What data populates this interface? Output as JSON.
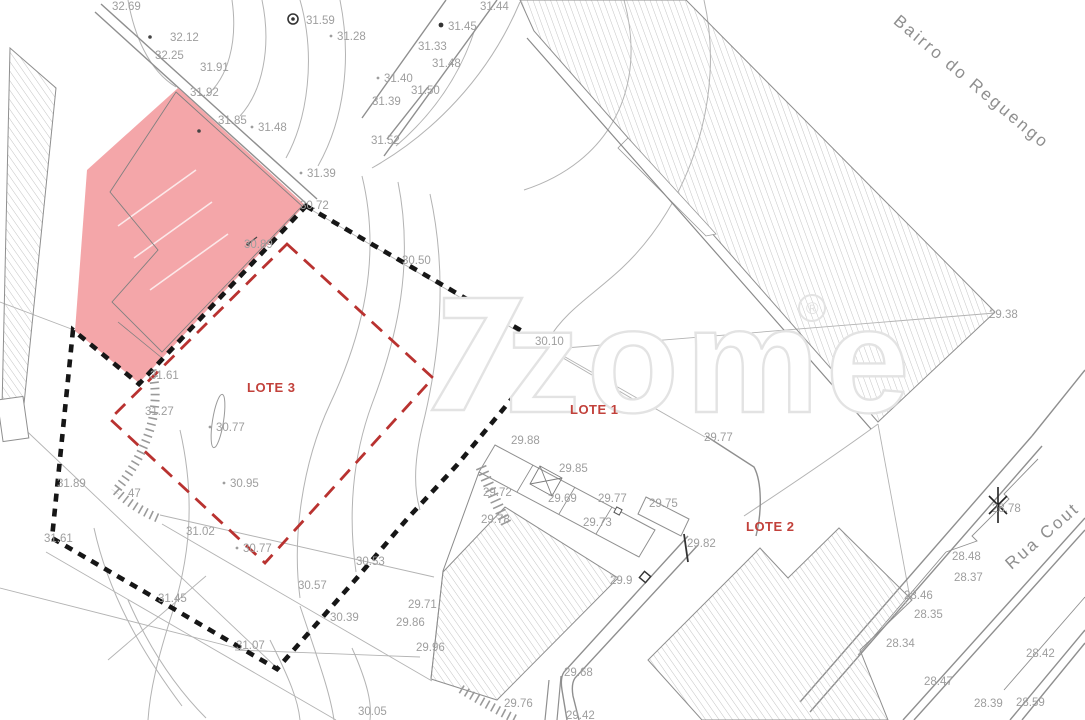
{
  "colors": {
    "pink": "#f4a6a9",
    "red_dash": "#b93230",
    "lot_red": "#c2413b",
    "elev_gray": "#9e9e9e",
    "line_gray": "#b3b3b3",
    "road_gray": "#8f8f8f",
    "hatch_gray": "#bdbdbd"
  },
  "watermark": {
    "text": "zome",
    "registered": "®"
  },
  "streets": [
    {
      "name": "Bairro do Reguengo",
      "x": 968,
      "y": 86,
      "rotate": 40
    },
    {
      "name": "Rua Cout",
      "x": 1046,
      "y": 540,
      "rotate": -41
    }
  ],
  "lots": [
    {
      "label": "LOTE 3",
      "x": 247,
      "y": 392
    },
    {
      "label": "LOTE 1",
      "x": 570,
      "y": 414
    },
    {
      "label": "LOTE 2",
      "x": 746,
      "y": 531
    }
  ],
  "elevations": [
    {
      "x": 112,
      "y": 10,
      "v": "32.69"
    },
    {
      "x": 170,
      "y": 41,
      "v": "32.12"
    },
    {
      "x": 155,
      "y": 59,
      "v": "32.25"
    },
    {
      "x": 200,
      "y": 71,
      "v": "31.91"
    },
    {
      "x": 306,
      "y": 24,
      "v": "31.59"
    },
    {
      "x": 337,
      "y": 40,
      "v": "31.28",
      "dot": true
    },
    {
      "x": 190,
      "y": 96,
      "v": "31.92"
    },
    {
      "x": 218,
      "y": 124,
      "v": "31.85"
    },
    {
      "x": 258,
      "y": 131,
      "v": "31.48",
      "dot": true
    },
    {
      "x": 480,
      "y": 10,
      "v": "31.44"
    },
    {
      "x": 448,
      "y": 30,
      "v": "31.45"
    },
    {
      "x": 418,
      "y": 50,
      "v": "31.33"
    },
    {
      "x": 432,
      "y": 67,
      "v": "31.48"
    },
    {
      "x": 384,
      "y": 82,
      "v": "31.40",
      "dot": true
    },
    {
      "x": 411,
      "y": 94,
      "v": "31.50"
    },
    {
      "x": 372,
      "y": 105,
      "v": "31.39"
    },
    {
      "x": 371,
      "y": 144,
      "v": "31.52"
    },
    {
      "x": 307,
      "y": 177,
      "v": "31.39",
      "dot": true
    },
    {
      "x": 300,
      "y": 209,
      "v": "30.72"
    },
    {
      "x": 244,
      "y": 248,
      "v": "30.89"
    },
    {
      "x": 402,
      "y": 264,
      "v": "30.50"
    },
    {
      "x": 535,
      "y": 345,
      "v": "30.10"
    },
    {
      "x": 150,
      "y": 379,
      "v": "31.61"
    },
    {
      "x": 145,
      "y": 415,
      "v": "31.27"
    },
    {
      "x": 216,
      "y": 431,
      "v": "30.77",
      "dot": true
    },
    {
      "x": 57,
      "y": 487,
      "v": "31.89"
    },
    {
      "x": 230,
      "y": 487,
      "v": "30.95",
      "dot": true
    },
    {
      "x": 128,
      "y": 497,
      "v": "47"
    },
    {
      "x": 44,
      "y": 542,
      "v": "31.61"
    },
    {
      "x": 186,
      "y": 535,
      "v": "31.02"
    },
    {
      "x": 243,
      "y": 552,
      "v": "30.77",
      "dot": true
    },
    {
      "x": 158,
      "y": 602,
      "v": "31.45"
    },
    {
      "x": 236,
      "y": 649,
      "v": "31.07"
    },
    {
      "x": 298,
      "y": 589,
      "v": "30.57"
    },
    {
      "x": 330,
      "y": 621,
      "v": "30.39"
    },
    {
      "x": 356,
      "y": 565,
      "v": "30.53"
    },
    {
      "x": 358,
      "y": 715,
      "v": "30.05"
    },
    {
      "x": 408,
      "y": 608,
      "v": "29.71"
    },
    {
      "x": 396,
      "y": 626,
      "v": "29.86"
    },
    {
      "x": 416,
      "y": 651,
      "v": "29.96"
    },
    {
      "x": 504,
      "y": 707,
      "v": "29.76"
    },
    {
      "x": 566,
      "y": 719,
      "v": "29.42"
    },
    {
      "x": 564,
      "y": 676,
      "v": "29.68"
    },
    {
      "x": 511,
      "y": 444,
      "v": "29.88"
    },
    {
      "x": 559,
      "y": 472,
      "v": "29.85"
    },
    {
      "x": 483,
      "y": 496,
      "v": "29.72"
    },
    {
      "x": 481,
      "y": 523,
      "v": "29.78"
    },
    {
      "x": 548,
      "y": 502,
      "v": "29.69"
    },
    {
      "x": 598,
      "y": 502,
      "v": "29.77"
    },
    {
      "x": 583,
      "y": 526,
      "v": "29.73"
    },
    {
      "x": 649,
      "y": 507,
      "v": "29.75"
    },
    {
      "x": 704,
      "y": 441,
      "v": "29.77"
    },
    {
      "x": 687,
      "y": 547,
      "v": "29.82"
    },
    {
      "x": 610,
      "y": 584,
      "v": "29.9"
    },
    {
      "x": 989,
      "y": 318,
      "v": "29.38"
    },
    {
      "x": 992,
      "y": 512,
      "v": "28.78"
    },
    {
      "x": 952,
      "y": 560,
      "v": "28.48"
    },
    {
      "x": 954,
      "y": 581,
      "v": "28.37"
    },
    {
      "x": 904,
      "y": 599,
      "v": "28.46"
    },
    {
      "x": 914,
      "y": 618,
      "v": "28.35"
    },
    {
      "x": 886,
      "y": 647,
      "v": "28.34"
    },
    {
      "x": 924,
      "y": 685,
      "v": "28.47"
    },
    {
      "x": 974,
      "y": 707,
      "v": "28.39"
    },
    {
      "x": 1016,
      "y": 706,
      "v": "28.59"
    },
    {
      "x": 1026,
      "y": 657,
      "v": "28.42"
    }
  ]
}
